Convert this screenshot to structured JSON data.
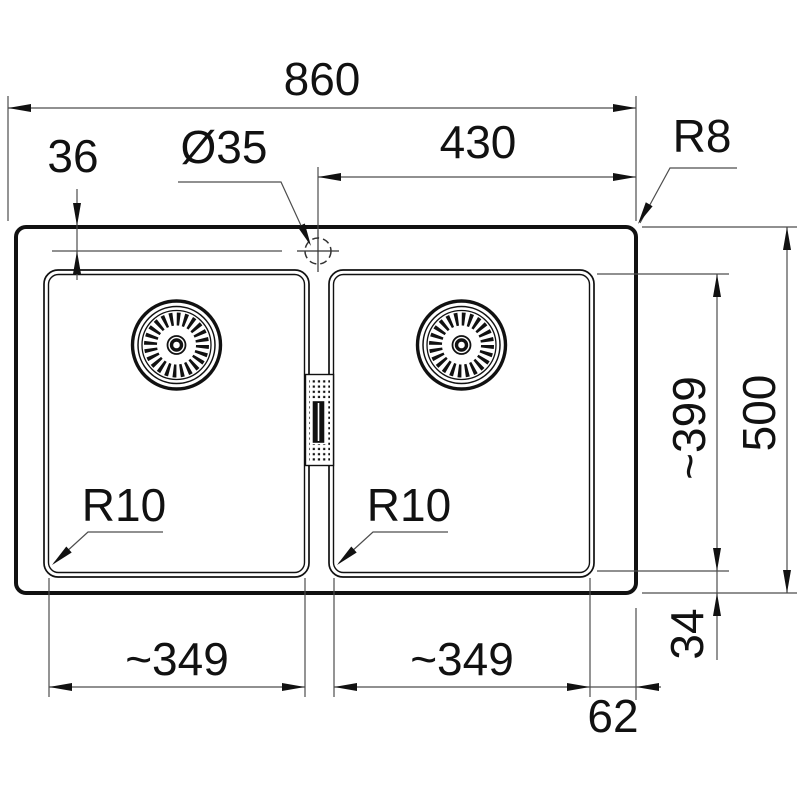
{
  "drawing": {
    "type": "technical-dimension-drawing",
    "subject": "double-bowl-inset-sink-top-view",
    "colors": {
      "background": "#ffffff",
      "outline": "#111111",
      "dimension_lines": "#4d4d4d",
      "text": "#111111"
    },
    "dimensions": {
      "overall_width": "860",
      "tap_center_to_right_edge": "430",
      "deck_corner_radius": "R8",
      "tap_center_offset_from_top": "36",
      "tap_hole_diameter": "Ø35",
      "bowl_length": "~399",
      "overall_depth": "500",
      "bowl_corner_radius_left": "R10",
      "bowl_corner_radius_right": "R10",
      "bowl_width_left": "~349",
      "bowl_width_right": "~349",
      "bowl_to_bottom_edge": "34",
      "bowl_to_side_edge": "62"
    }
  }
}
